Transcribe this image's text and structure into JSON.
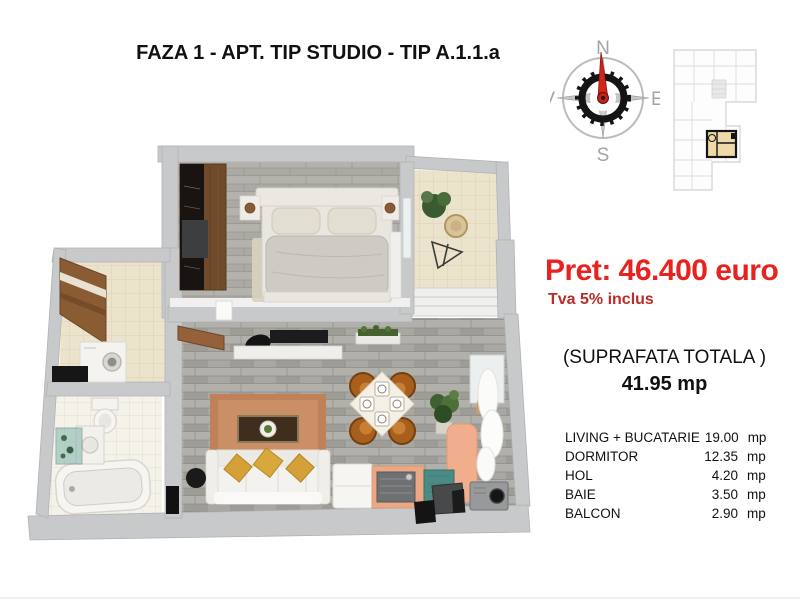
{
  "title": "FAZA 1 - APT. TIP STUDIO - TIP A.1.1.a",
  "compass": {
    "north": "N",
    "south": "S",
    "east": "E",
    "west": "V"
  },
  "pricing": {
    "price": "Pret: 46.400 euro",
    "vat_note": "Tva 5% inclus"
  },
  "surface": {
    "label": "(SUPRAFATA TOTALA )",
    "total": "41.95 mp"
  },
  "rooms": [
    {
      "name": "LIVING + BUCATARIE",
      "area": "19.00",
      "unit": "mp"
    },
    {
      "name": "DORMITOR",
      "area": "12.35",
      "unit": "mp"
    },
    {
      "name": "HOL",
      "area": "4.20",
      "unit": "mp"
    },
    {
      "name": "BAIE",
      "area": "3.50",
      "unit": "mp"
    },
    {
      "name": "BALCON",
      "area": "2.90",
      "unit": "mp"
    }
  ],
  "colors": {
    "price_red": "#e8231f",
    "vat_red": "#bb2d28",
    "wall_gray": "#c7c9cb",
    "floor_stone": "#a8a6a1",
    "floor_cream": "#ece3cd",
    "bath_tile": "#f5f2ea",
    "rug_copper": "#c58963",
    "pillow_yellow": "#d3a138",
    "wardrobe_wood": "#6f4b2c",
    "chair_brown": "#a85f1e",
    "kitchen_salmon": "#eba884",
    "teal_mat": "#4c8b85",
    "unit_highlight": "#eed9a9",
    "needle_red": "#d3241c"
  }
}
